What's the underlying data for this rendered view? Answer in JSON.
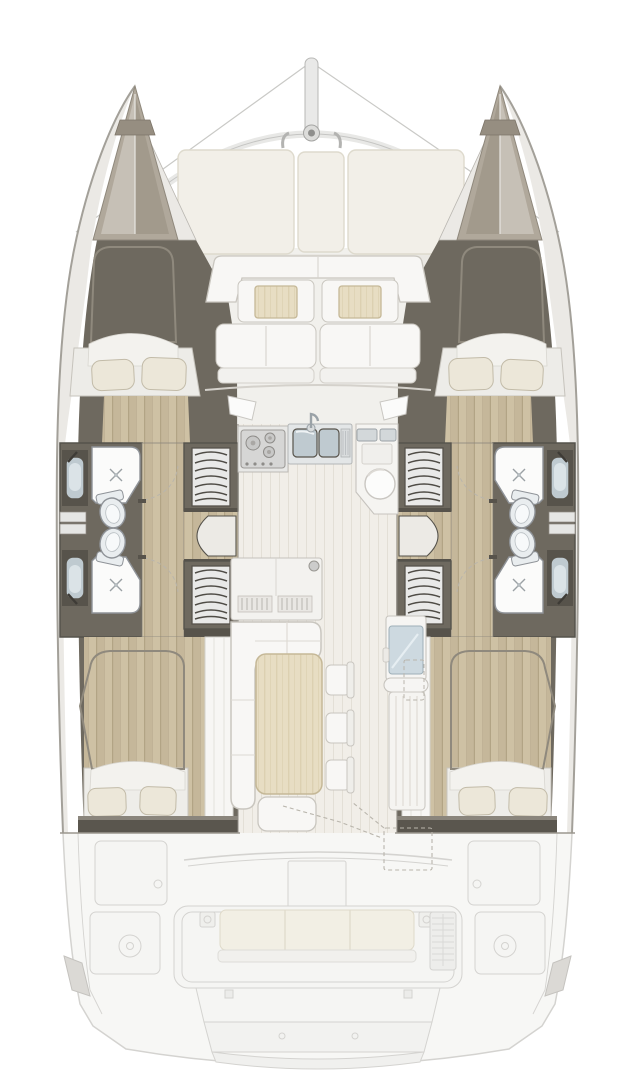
{
  "title": "catamaran-interior-deck-plan",
  "regions": {
    "mast": "mast-and-rigging",
    "foredeck": "foredeck-sun-cushions",
    "forward_cockpit": "forward-cockpit-seating",
    "galley": "galley-stove-and-sink",
    "salon": "salon-dining-area",
    "port_hull": "port-hull-cabins-and-heads",
    "starboard_hull": "starboard-hull-cabins-and-heads",
    "aft_deck": "aft-cockpit-and-transom"
  },
  "features": {
    "cabins": 4,
    "bathrooms": 4,
    "showers": 4,
    "toilets": 4,
    "staircases": 2,
    "salon_chairs": 3,
    "foredeck_cushion_panels": 3,
    "forward_cockpit_tables": 2,
    "aft_bench_seats": 3
  },
  "colors": {
    "bg": "#ffffff",
    "hull-stroke": "#a3a099",
    "deck-band": "#ebe9e5",
    "bow-outer": "#b0a89b",
    "bow-light": "#c6c0b6",
    "bow-shadow": "#a29a8c",
    "wall-dark": "#6e695f",
    "wall-darker": "#57534b",
    "wood-base": "#cec1a4",
    "wood-stripe": "#c5b79a",
    "wood-line": "#b2a485",
    "duvet-base": "#d8d1c2",
    "duvet-stripe": "#cec6b5",
    "duvet-stroke": "#8f897d",
    "sheet": "#f3f2ee",
    "pillow": "#ece7d9",
    "pillow-stroke": "#c2bba8",
    "furn-white": "#f8f7f5",
    "furn-stroke": "#c9c6bf",
    "salon-floor": "#f1eee8",
    "salon-line": "#e3dfd6",
    "table-wood": "#e7ddc3",
    "table-grain": "#dcd0b1",
    "table-stroke": "#c5b897",
    "steel": "#d3d8da",
    "steel-stroke": "#9aa1a5",
    "basin": "#bfcad0",
    "shower": "#fbfbfa",
    "fixture-stroke": "#8f9398",
    "toilet": "#e9edef",
    "glass-blue": "#cdd9e0",
    "stair-tread": "#e9e9e8",
    "stair-line": "#4f4c46",
    "ghost-stroke": "#d4d3d0",
    "ghost-fill": "#f5f5f3",
    "ghost-cushion": "#f2efe4",
    "ghost-cushion-stroke": "#dfdaca",
    "rig": "#c9c9c6",
    "mast": "#e9e9e8",
    "dash": "#b9b5ac"
  }
}
